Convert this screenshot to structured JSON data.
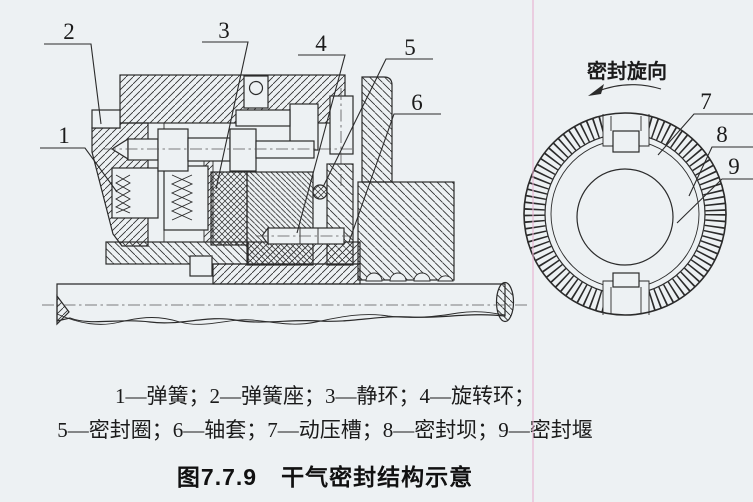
{
  "figure": {
    "caption": "图7.7.9　干气密封结构示意",
    "legend_line1": "1—弹簧；2—弹簧座；3—静环；4—旋转环；",
    "legend_line2": "5—密封圈；6—轴套；7—动压槽；8—密封坝；9—密封堰"
  },
  "left_view": {
    "callouts": [
      "1",
      "2",
      "3",
      "4",
      "5",
      "6"
    ]
  },
  "right_view": {
    "rotation_label": "密封旋向",
    "callouts": [
      "7",
      "8",
      "9"
    ]
  },
  "colors": {
    "paper": "#edf1f3",
    "ink": "#2b2b2b",
    "scan_artifact": "#e7aed0"
  }
}
